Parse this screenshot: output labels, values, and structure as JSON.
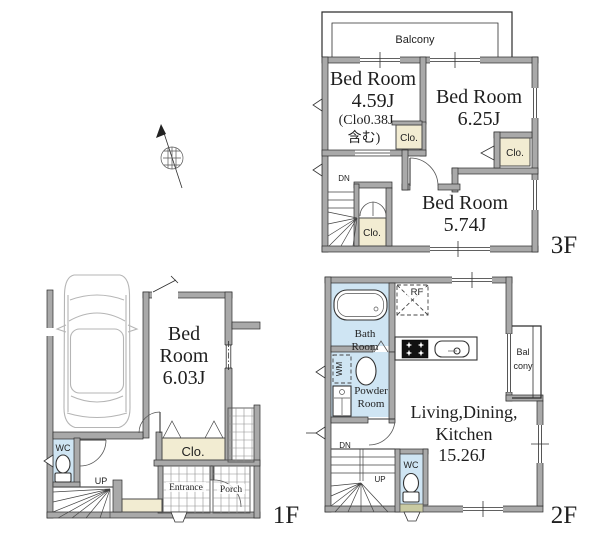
{
  "title": "House floor plan 1F 2F 3F",
  "colors": {
    "wall": "#a9a9a9",
    "closet": "#f2ecd2",
    "wet": "#cfe5f3",
    "tile": "#8f8f8f",
    "car": "#b5b5b5",
    "window_sill": "#c9caa2",
    "text": "#1f1f1f"
  },
  "f3": {
    "floor_label": "3F",
    "balcony": "Balcony",
    "bedroom1": {
      "name": "Bed Room",
      "size": "4.59J",
      "note_line1": "(Clo0.38J",
      "note_line2": "含む)"
    },
    "bedroom2": {
      "name": "Bed Room",
      "size": "6.25J"
    },
    "bedroom3": {
      "name": "Bed Room",
      "size": "5.74J"
    },
    "closet1": "Clo.",
    "closet2": "Clo.",
    "closet3": "Clo.",
    "stairs_down": "DN"
  },
  "f2": {
    "floor_label": "2F",
    "ldk": {
      "name_line1": "Living,Dining,",
      "name_line2": "Kitchen",
      "size": "15.26J"
    },
    "bath": {
      "line1": "Bath",
      "line2": "Room"
    },
    "powder": {
      "line1": "Powder",
      "line2": "Room"
    },
    "balcony": {
      "line1": "Bal",
      "line2": "cony"
    },
    "refrigerator": "RF",
    "washing_machine": "WM",
    "wc": "WC",
    "stairs_down": "DN",
    "stairs_up": "UP"
  },
  "f1": {
    "floor_label": "1F",
    "bedroom": {
      "name_line1": "Bed",
      "name_line2": "Room",
      "size": "6.03J"
    },
    "closet": "Clo.",
    "wc": "WC",
    "stairs_up": "UP",
    "entrance": "Entrance",
    "porch": "Porch"
  }
}
